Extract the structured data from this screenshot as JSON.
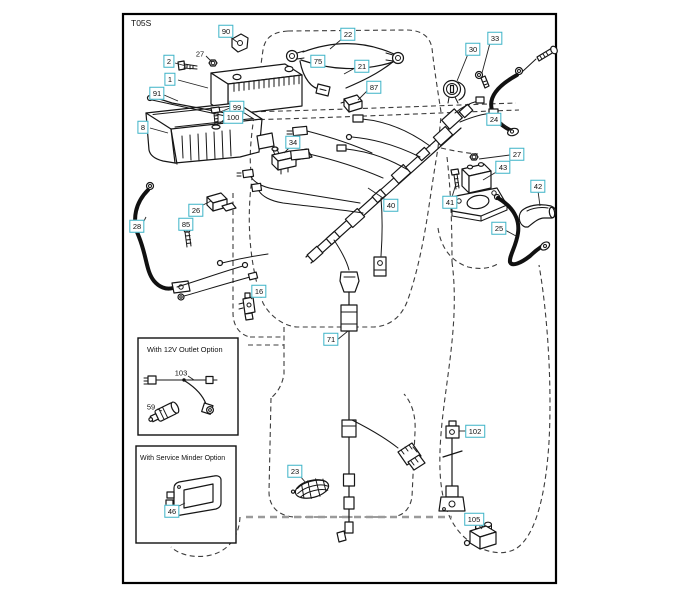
{
  "diagram": {
    "code": "T05S",
    "accent_color": "#3db3c7",
    "insets": [
      {
        "title": "With 12V Outlet Option"
      },
      {
        "title": "With Service Minder Option"
      }
    ],
    "callouts": [
      {
        "id": "90",
        "x": 226,
        "y": 31,
        "leader": [
          229,
          36,
          237,
          42
        ]
      },
      {
        "id": "2",
        "x": 169,
        "y": 61,
        "leader": [
          175,
          63,
          186,
          66
        ]
      },
      {
        "id": "27",
        "x": 200,
        "y": 54,
        "boxed": false,
        "leader": [
          206,
          56,
          212,
          62
        ]
      },
      {
        "id": "1",
        "x": 170,
        "y": 79,
        "leader": [
          178,
          80,
          208,
          88
        ]
      },
      {
        "id": "91",
        "x": 157,
        "y": 93,
        "leader": [
          164,
          95,
          178,
          101
        ]
      },
      {
        "id": "99",
        "x": 237,
        "y": 107,
        "leader": [
          230,
          108,
          220,
          112
        ]
      },
      {
        "id": "100",
        "x": 233,
        "y": 117,
        "leader": [
          226,
          118,
          219,
          124
        ]
      },
      {
        "id": "8",
        "x": 143,
        "y": 127,
        "leader": [
          150,
          128,
          168,
          133
        ]
      },
      {
        "id": "22",
        "x": 348,
        "y": 34,
        "leader": [
          343,
          38,
          330,
          49
        ]
      },
      {
        "id": "75",
        "x": 318,
        "y": 61
      },
      {
        "id": "21",
        "x": 362,
        "y": 66,
        "leader": [
          355,
          68,
          344,
          74
        ]
      },
      {
        "id": "87",
        "x": 374,
        "y": 87,
        "leader": [
          368,
          90,
          358,
          100
        ]
      },
      {
        "id": "33",
        "x": 495,
        "y": 38,
        "leader": [
          490,
          43,
          482,
          73
        ]
      },
      {
        "id": "30",
        "x": 473,
        "y": 49,
        "leader": [
          468,
          54,
          457,
          81
        ]
      },
      {
        "id": "24",
        "x": 494,
        "y": 119,
        "leader": [
          500,
          121,
          508,
          129
        ]
      },
      {
        "id": "27",
        "x": 517,
        "y": 154,
        "leader": [
          510,
          155,
          479,
          159
        ]
      },
      {
        "id": "43",
        "x": 503,
        "y": 167,
        "leader": [
          498,
          171,
          483,
          180
        ]
      },
      {
        "id": "41",
        "x": 450,
        "y": 202,
        "leader": [
          452,
          197,
          456,
          184
        ]
      },
      {
        "id": "42",
        "x": 538,
        "y": 186,
        "leader": [
          538,
          191,
          540,
          206
        ]
      },
      {
        "id": "25",
        "x": 499,
        "y": 228,
        "leader": [
          505,
          230,
          516,
          236
        ]
      },
      {
        "id": "26",
        "x": 196,
        "y": 210,
        "leader": [
          201,
          206,
          211,
          201
        ]
      },
      {
        "id": "28",
        "x": 137,
        "y": 226,
        "leader": [
          143,
          223,
          146,
          217
        ]
      },
      {
        "id": "85",
        "x": 186,
        "y": 224,
        "leader": [
          187,
          228,
          187,
          232
        ]
      },
      {
        "id": "34",
        "x": 293,
        "y": 142,
        "leader": [
          290,
          147,
          284,
          153
        ]
      },
      {
        "id": "40",
        "x": 391,
        "y": 205,
        "leader": [
          386,
          200,
          368,
          188
        ]
      },
      {
        "id": "16",
        "x": 259,
        "y": 291,
        "leader": [
          255,
          295,
          251,
          299
        ]
      },
      {
        "id": "71",
        "x": 331,
        "y": 339,
        "leader": [
          337,
          340,
          348,
          331
        ]
      },
      {
        "id": "23",
        "x": 295,
        "y": 471,
        "leader": [
          300,
          476,
          306,
          483
        ]
      },
      {
        "id": "103",
        "x": 181,
        "y": 373,
        "boxed": false,
        "leader": [
          188,
          376,
          194,
          380
        ]
      },
      {
        "id": "59",
        "x": 151,
        "y": 407,
        "boxed": false,
        "leader": [
          157,
          409,
          162,
          411
        ]
      },
      {
        "id": "46",
        "x": 172,
        "y": 511,
        "leader": [
          177,
          507,
          185,
          503
        ]
      },
      {
        "id": "102",
        "x": 475,
        "y": 431,
        "leader": [
          468,
          431,
          459,
          431
        ]
      },
      {
        "id": "105",
        "x": 474,
        "y": 519,
        "leader": [
          478,
          524,
          482,
          529
        ]
      }
    ]
  }
}
